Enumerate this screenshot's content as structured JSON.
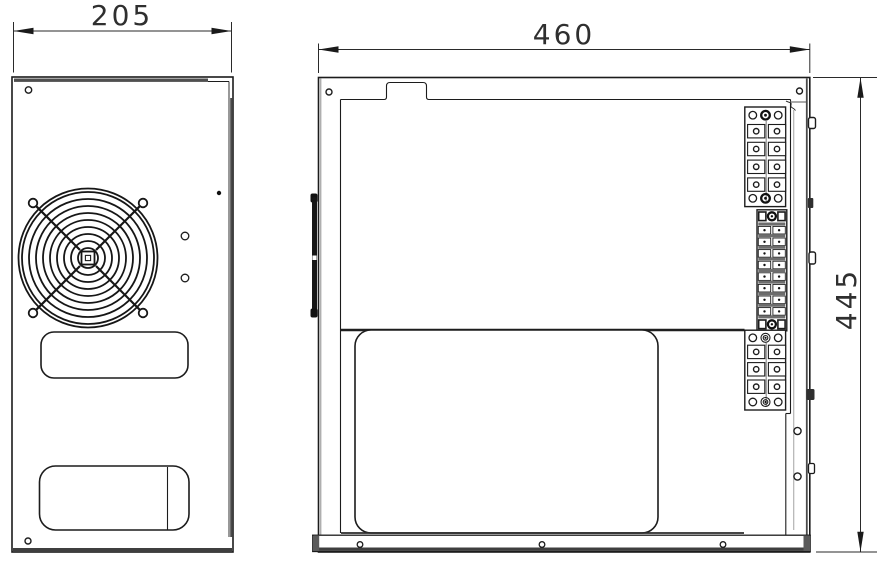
{
  "dimensions": {
    "left_panel_width": {
      "value": "205"
    },
    "side_panel_width": {
      "value": "460"
    },
    "panel_height": {
      "value": "445"
    }
  },
  "colors": {
    "line": "#1c1c1c",
    "thick_edge": "#4a4a4a",
    "dim_text": "#2f2f2f",
    "background": "#ffffff"
  },
  "icons": {
    "left_view": [
      "fan-grille-icon",
      "vent-slot-upper",
      "vent-slot-lower",
      "screw-hole",
      "pilot-hole"
    ],
    "right_view": [
      "terminal-block-top",
      "terminal-strip-din",
      "terminal-block-bottom",
      "service-cutout",
      "hinge-bar",
      "bottom-rail",
      "edge-clip",
      "screw-hole",
      "break-line"
    ]
  }
}
